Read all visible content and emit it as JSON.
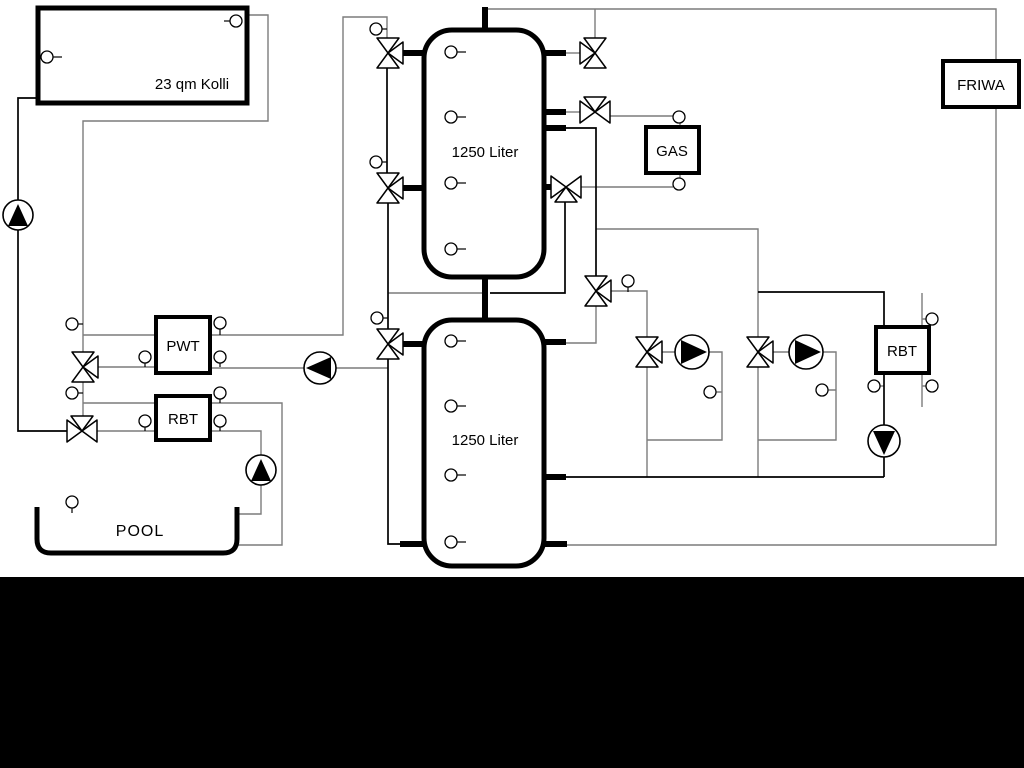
{
  "diagram": {
    "title_context": "heating-system-schematic",
    "labels": {
      "collector": "23 qm Kolli",
      "tank_top": "1250 Liter",
      "tank_bottom": "1250 Liter",
      "gas": "GAS",
      "friwa": "FRIWA",
      "pwt": "PWT",
      "rbt_left": "RBT",
      "rbt_right": "RBT",
      "pool": "POOL"
    },
    "colors": {
      "pipe_gray": "#7c7c7c",
      "pipe_black": "#000000",
      "component_fill": "#ffffff",
      "footer_band": "#000000",
      "background": "#ffffff"
    }
  }
}
